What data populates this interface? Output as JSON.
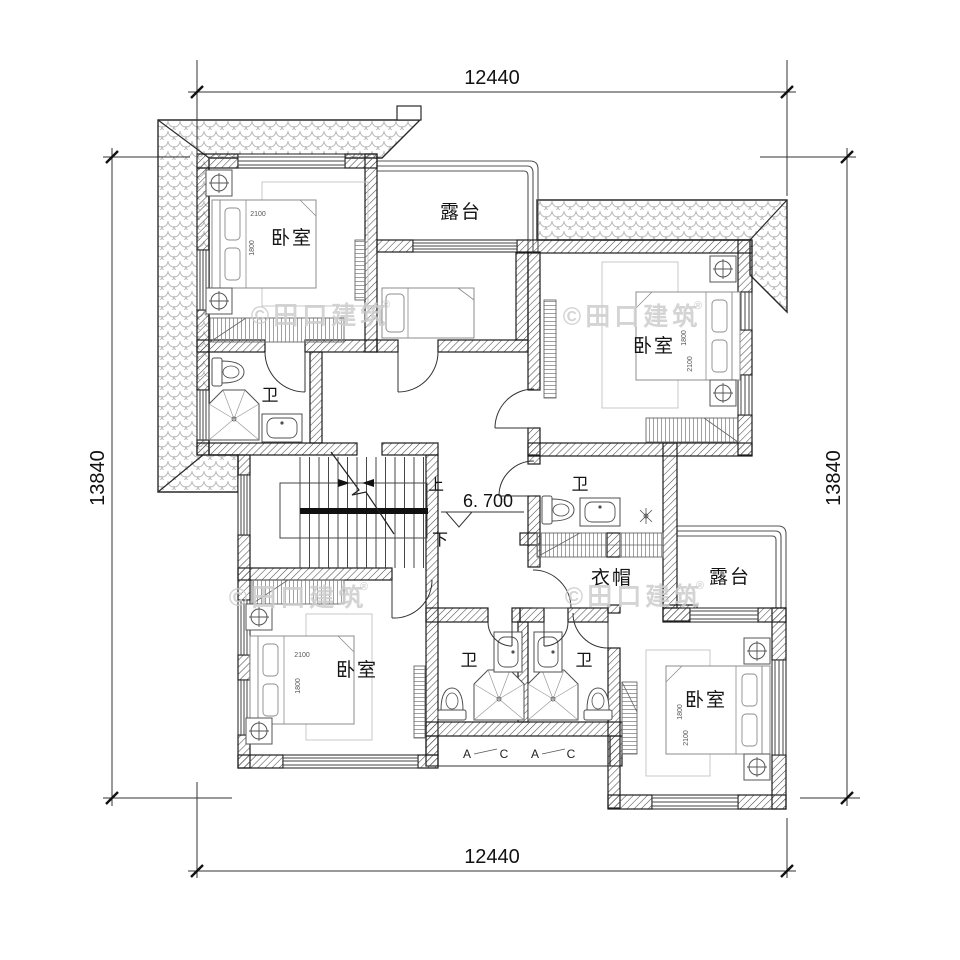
{
  "dimensions": {
    "top": "12440",
    "bottom": "12440",
    "left": "13840",
    "right": "13840"
  },
  "elevation_label": "6. 700",
  "stairs": {
    "up": "上",
    "down": "下"
  },
  "room_labels": {
    "bedroom_top_left": "卧室",
    "bedroom_top_right": "卧室",
    "bedroom_bottom_left": "卧室",
    "bedroom_bottom_right": "卧室",
    "terrace_top": "露台",
    "terrace_bottom_right": "露台",
    "bath_top_left": "卫",
    "bath_middle": "卫",
    "bath_bottom_left": "卫",
    "bath_bottom_right": "卫",
    "cloakroom": "衣帽"
  },
  "bed_dimensions": {
    "width": "2100",
    "depth": "1800"
  },
  "section_tags": {
    "a": "A",
    "c": "C"
  },
  "watermark": {
    "text": "©田口建筑",
    "registered": "®"
  },
  "colors": {
    "line": "#1c1c1c",
    "furniture": "#8c8c8c",
    "roof_tile": "#b9b9b9",
    "watermark": "#cdcdcd"
  }
}
